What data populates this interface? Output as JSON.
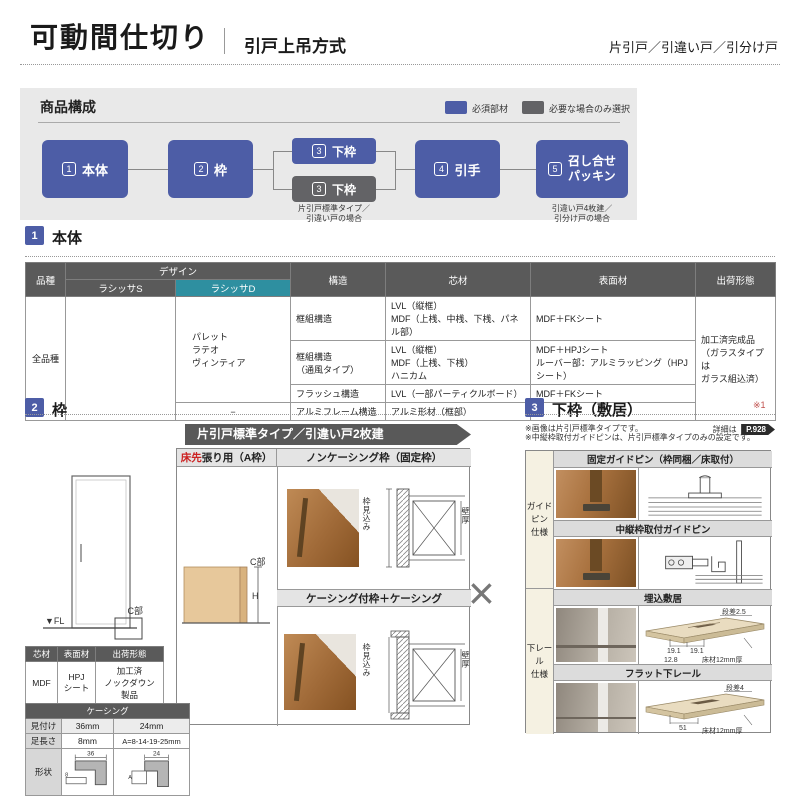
{
  "colors": {
    "accent_blue": "#4d5da6",
    "accent_gray": "#636366",
    "accent_teal": "#2e8fa0"
  },
  "header": {
    "title": "可動間仕切り",
    "subtitle": "引戸上吊方式",
    "door_types": "片引戸／引違い戸／引分け戸"
  },
  "composition": {
    "title": "商品構成",
    "legend_required": "必須部材",
    "legend_optional": "必要な場合のみ選択",
    "nodes": [
      {
        "num": "1",
        "label": "本体"
      },
      {
        "num": "2",
        "label": "枠"
      },
      {
        "num": "3",
        "label": "下枠"
      },
      {
        "num": "3",
        "label": "下枠"
      },
      {
        "num": "4",
        "label": "引手"
      },
      {
        "num": "5",
        "label": "召し合せ\nパッキン"
      }
    ],
    "caption_shitawaku": "片引戸標準タイプ／\n引違い戸の場合",
    "caption_packing": "引違い戸4枚建／\n引分け戸の場合"
  },
  "section_hontai": {
    "num": "1",
    "title": "本体",
    "table": {
      "col_hinshu": "品種",
      "col_design": "デザイン",
      "col_lasissa_s": "ラシッサS",
      "col_lasissa_d": "ラシッサD",
      "col_kouzou": "構造",
      "col_shinzai": "芯材",
      "col_hyomenzai": "表面材",
      "col_shukka": "出荷形態",
      "hinshu": "全品種",
      "design_d": "パレット\nラテオ\nヴィンティア",
      "design_d_last": "−",
      "rows": [
        {
          "kouzou": "框組構造",
          "shinzai": "LVL（縦框）\nMDF（上桟、中桟、下桟、パネル部）",
          "hyomen": "MDF＋FKシート"
        },
        {
          "kouzou": "框組構造\n（通風タイプ）",
          "shinzai": "LVL（縦框）\nMDF（上桟、下桟）\nハニカム",
          "hyomen": "MDF＋HPJシート\nルーバー部：アルミラッピング（HPJシート）"
        },
        {
          "kouzou": "フラッシュ構造",
          "shinzai": "LVL（一部パーティクルボード）",
          "hyomen": "MDF＋FKシート"
        },
        {
          "kouzou": "アルミフレーム構造",
          "shinzai": "アルミ形材（框部）",
          "hyomen": "−"
        }
      ],
      "shukka": "加工済完成品\n（ガラスタイプは\nガラス組込済）"
    }
  },
  "section_waku": {
    "num": "2",
    "title": "枠",
    "banner": "片引戸標準タイプ／引違い戸2枚建",
    "col1_header_red": "床先",
    "col1_header_rest": "張り用（A枠）",
    "col2_header1": "ノンケーシング枠（固定枠）",
    "col2_header2": "ケーシング付枠＋ケーシング",
    "fl_label": "▼FL",
    "cbu_label": "C部",
    "cbu_label2": "C部",
    "h_label": "H",
    "waku_mikomi": "枠見込み",
    "kabeatsu": "壁厚",
    "material_table": {
      "h_shinzai": "芯材",
      "h_hyomen": "表面材",
      "h_shukka": "出荷形態",
      "shinzai": "MDF",
      "hyomen": "HPJ\nシート",
      "shukka": "加工済\nノックダウン\n製品"
    },
    "casing_table": {
      "title": "ケーシング",
      "r1_label": "見付け",
      "r1_v1": "36mm",
      "r1_v2": "24mm",
      "r2_label": "足長さ",
      "r2_v1": "8mm",
      "r2_v2": "A=8-14-19-25mm",
      "r3_label": "形状",
      "dim36": "36",
      "dim24": "24",
      "dim8": "8",
      "dimA": "A"
    }
  },
  "combine_mark": "×",
  "section_shitawaku": {
    "num": "3",
    "title": "下枠（敷居）",
    "ref_mark": "※1",
    "note1": "※画像は片引戸標準タイプです。",
    "note1b": "詳細は",
    "page_badge": "P.928",
    "note2": "※中縦枠取付ガイドピンは、片引戸標準タイプのみの設定です。",
    "row_group1": "ガイドピン\n仕様",
    "row_group2": "下レール\n仕様",
    "h1": "固定ガイドピン（枠同梱／床取付）",
    "h2": "中縦枠取付ガイドピン",
    "h3": "埋込敷居",
    "h4": "フラット下レール",
    "umekomi": {
      "dansa": "段差2.5",
      "d1": "19.1",
      "d2": "19.1",
      "d3": "12.8",
      "yukazai": "床材12mm厚"
    },
    "flat": {
      "dansa": "段差4",
      "d1": "51",
      "yukazai": "床材12mm厚"
    }
  }
}
